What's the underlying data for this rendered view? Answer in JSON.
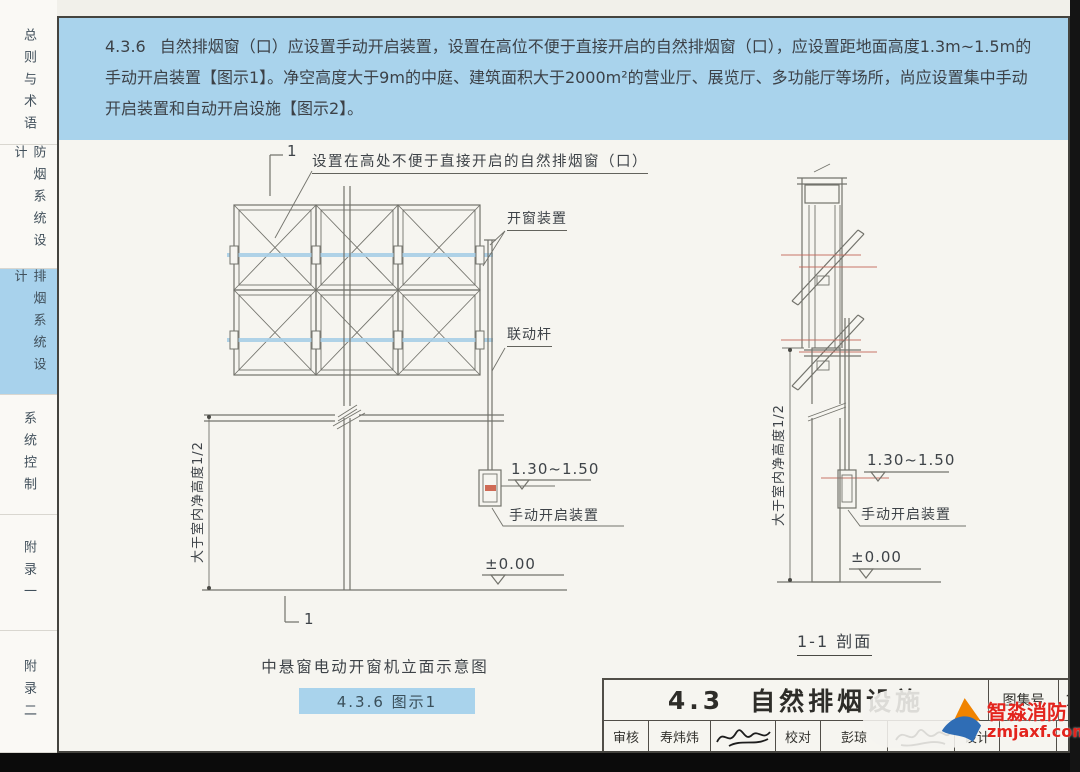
{
  "sidebar": {
    "tabs": [
      {
        "label": "总则与术语",
        "active": false
      },
      {
        "label": "防烟系统设计",
        "active": false
      },
      {
        "label": "排烟系统设计",
        "active": true
      },
      {
        "label": "系统控制",
        "active": false
      },
      {
        "label": "附录一",
        "active": false
      },
      {
        "label": "附录二",
        "active": false
      }
    ]
  },
  "clause": {
    "number": "4.3.6",
    "text": "自然排烟窗（口）应设置手动开启装置，设置在高位不便于直接开启的自然排烟窗（口），应设置距地面高度1.3m~1.5m的手动开启装置【图示1】。净空高度大于9m的中庭、建筑面积大于2000m²的营业厅、展览厅、多功能厅等场所，尚应设置集中手动开启装置和自动开启设施【图示2】。"
  },
  "figure1": {
    "section_marker": "1",
    "annotation_window": "设置在高处不便于直接开启的自然排烟窗（口）",
    "annotation_opener": "开窗装置",
    "annotation_linkage": "联动杆",
    "dim_room_height": "大于室内净高度1/2",
    "elev_manual": "1.30~1.50",
    "annotation_manual": "手动开启装置",
    "elev_ground": "±0.00",
    "caption": "中悬窗电动开窗机立面示意图",
    "figure_tag": "4.3.6 图示1"
  },
  "figure2": {
    "dim_room_height": "大于室内净高度1/2",
    "elev_manual": "1.30~1.50",
    "annotation_manual": "手动开启装置",
    "elev_ground": "±0.00",
    "caption": "1-1 剖面"
  },
  "title_block": {
    "section_no": "4.3",
    "title": "自然排烟设施",
    "atlas_no_label": "图集号",
    "atlas_no_value": "15",
    "reviewer_label": "审核",
    "reviewer": "寿炜炜",
    "checker_label": "校对",
    "checker": "彭琼",
    "designer_label": "设计",
    "page_no": "9"
  },
  "watermark": {
    "brand": "智淼消防",
    "url": "zmjaxf.com"
  },
  "colors": {
    "band_blue": "#a9d3ec",
    "accent_red": "#c4685a",
    "watermark_red": "#e3241d"
  }
}
